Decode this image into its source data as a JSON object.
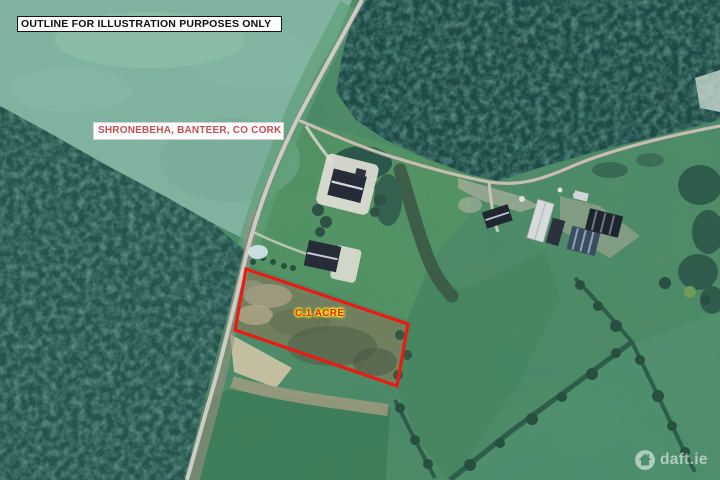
{
  "image": {
    "kind": "satellite-site-map",
    "disclaimer": "OUTLINE FOR ILLUSTRATION PURPOSES ONLY",
    "address": "SHRONEBEHA, BANTEER, CO CORK",
    "plot": {
      "label": "C.1 ACRE",
      "outline_color": "#ea1a12",
      "label_color": "#e02615",
      "label_glow_color": "#ffe81f"
    },
    "address_color": "#c25052",
    "watermark": {
      "brand": "daft.ie",
      "icon": "daft-house-icon",
      "color": "rgba(255,255,255,0.55)"
    }
  }
}
